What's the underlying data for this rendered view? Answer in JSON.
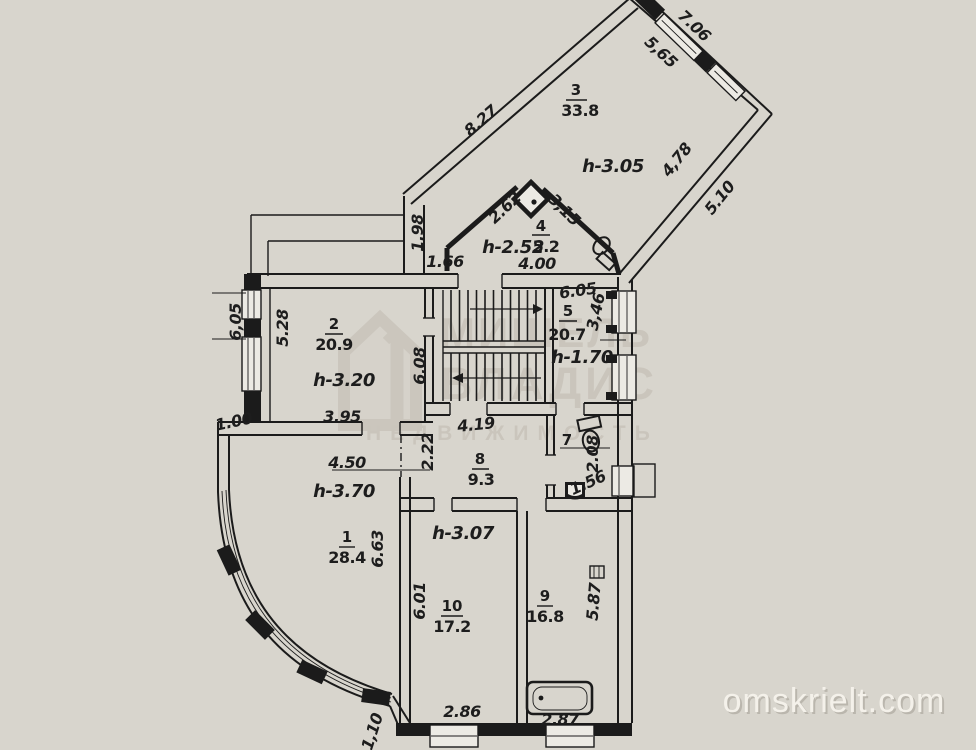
{
  "colors": {
    "paper": "#dad6ce",
    "ink": "#1b1b1b",
    "watermark_gray": "#c7c2b9",
    "site_watermark": "#f4f1ea"
  },
  "watermarks": {
    "site": "omskrielt.com",
    "agency_line1": "МИШЕЛЬ",
    "agency_line2": "ВЛАДИС",
    "agency_line3": "НЕДВИЖИМОСТЬ",
    "logo_digit": "1"
  },
  "rooms": {
    "r1": {
      "num": "1",
      "area": "28.4",
      "height": "h-3.70"
    },
    "r2": {
      "num": "2",
      "area": "20.9",
      "height": "h-3.20"
    },
    "r3": {
      "num": "3",
      "area": "33.8",
      "height": "h-3.05"
    },
    "r4": {
      "num": "4",
      "area": "5.2",
      "height": "h-2.52"
    },
    "r5": {
      "num": "5",
      "area": "20.7",
      "height": "h-1.70"
    },
    "r7": {
      "num": "7"
    },
    "r8": {
      "num": "8",
      "area": "9.3"
    },
    "r9": {
      "num": "9",
      "area": "16.8"
    },
    "r10": {
      "num": "10",
      "area": "17.2",
      "height": "h-3.07"
    }
  },
  "dims": {
    "room3_top_outer": "7.06",
    "room3_top_inner": "5,65",
    "room3_left": "8.27",
    "room3_right_inner": "4,78",
    "room3_right_outer": "5.10",
    "room4_left": "2.62",
    "room4_right": "3,15",
    "room4_bottom": "4.00",
    "room4_side": "1.66",
    "hall_left": "1.98",
    "room5_top": "6.05",
    "room5_right": "3,46",
    "room2_outer_left": "6,05",
    "room2_left": "5.28",
    "room2_bottom": "3.95",
    "room2_jog": "1.00",
    "stairs_left": "6.08",
    "room8_top": "4.19",
    "room8_left": "2.22",
    "room7_right": "2.08",
    "room7_bottom": "1.56",
    "room1_top": "4.50",
    "room1_right": "6.63",
    "room10_left": "6.01",
    "room10_bottom": "2.86",
    "room9_right": "5.87",
    "room9_bottom": "2.87",
    "bay_bottom": "1,10"
  }
}
